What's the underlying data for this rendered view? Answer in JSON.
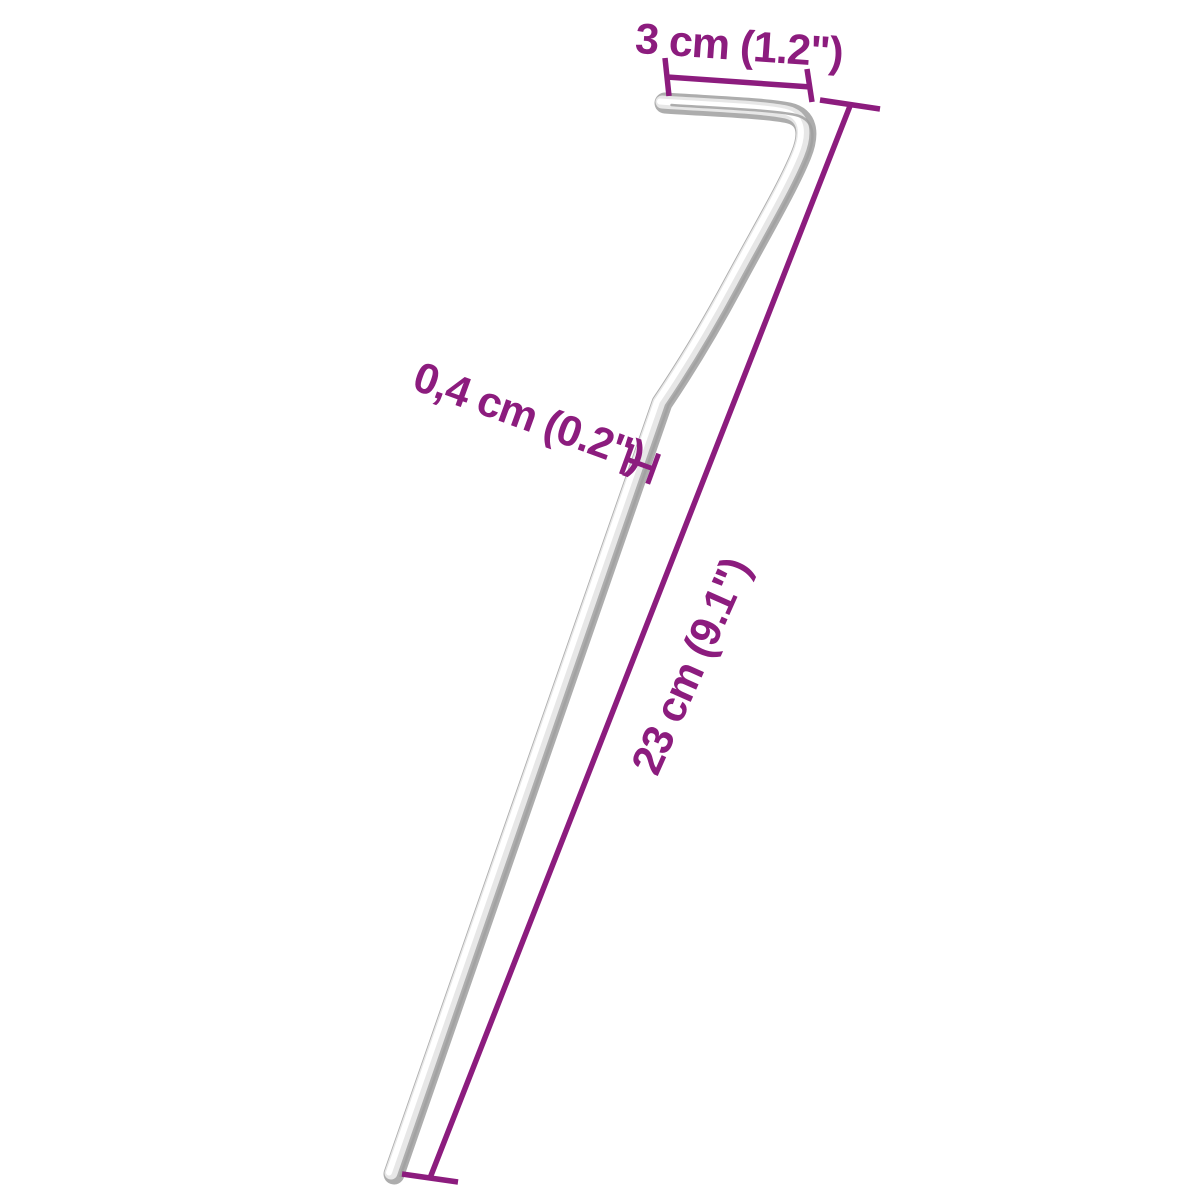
{
  "page": {
    "background": "#ffffff",
    "description": "Product dimension diagram of a galvanised steel tent peg with hook"
  },
  "colors": {
    "dimension": "#8C1C7E",
    "metal_edge": "#ADADAD",
    "metal_mid": "#E7E7E7",
    "metal_highlight": "#FFFFFF",
    "metal_shadow": "#A0A0A0"
  },
  "dimensions": {
    "hook_width": {
      "label": "3 cm (1.2\")"
    },
    "diameter": {
      "label": "0,4 cm (0.2\")"
    },
    "length": {
      "label": "23 cm (9.1\")"
    }
  }
}
